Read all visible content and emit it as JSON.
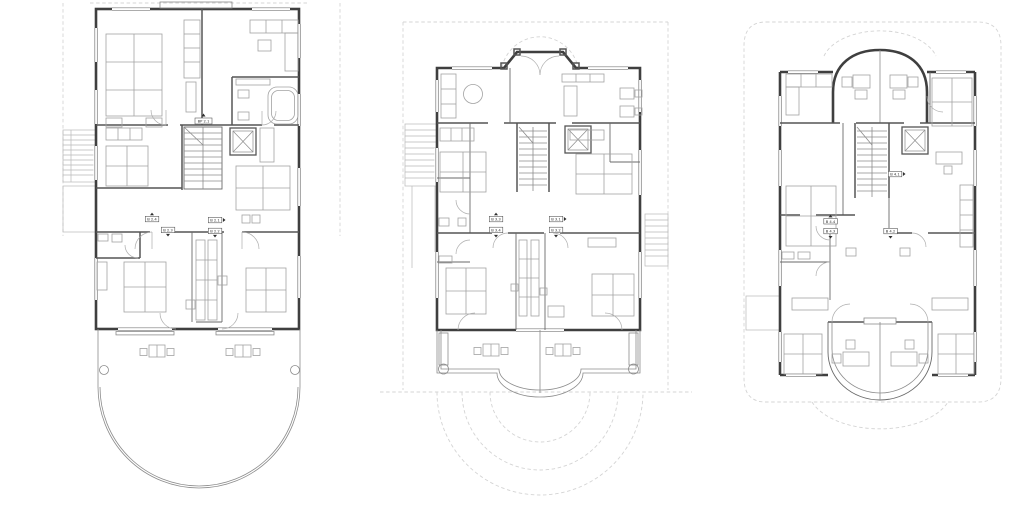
{
  "drawing": {
    "type": "architectural floor plans",
    "sheet_background": "#ffffff",
    "colors": {
      "outer_wall": "#3f3f3f",
      "interior_wall": "#555555",
      "furniture": "#a2a2a2",
      "setback_dashed": "#d4d4d4",
      "label_ink": "#2e2e2e"
    }
  },
  "plans": [
    {
      "name": "floor-plan-left",
      "stairwell_label": "BP 2.1",
      "units": [
        {
          "id": "B 2.4",
          "arrow": "up"
        },
        {
          "id": "B 2.3",
          "arrow": "down"
        },
        {
          "id": "B 2.1",
          "arrow": "right"
        },
        {
          "id": "B 2.2",
          "arrow": "down"
        }
      ]
    },
    {
      "name": "floor-plan-middle",
      "units": [
        {
          "id": "B 3.3",
          "arrow": "up"
        },
        {
          "id": "B 3.4",
          "arrow": "down"
        },
        {
          "id": "B 3.1",
          "arrow": "right"
        },
        {
          "id": "B 3.2",
          "arrow": "down"
        }
      ]
    },
    {
      "name": "floor-plan-right",
      "units": [
        {
          "id": "B 4.1",
          "arrow": "right"
        },
        {
          "id": "B 4.4",
          "arrow": "up"
        },
        {
          "id": "B 4.3",
          "arrow": "down"
        },
        {
          "id": "B 4.2",
          "arrow": "down"
        }
      ]
    }
  ]
}
